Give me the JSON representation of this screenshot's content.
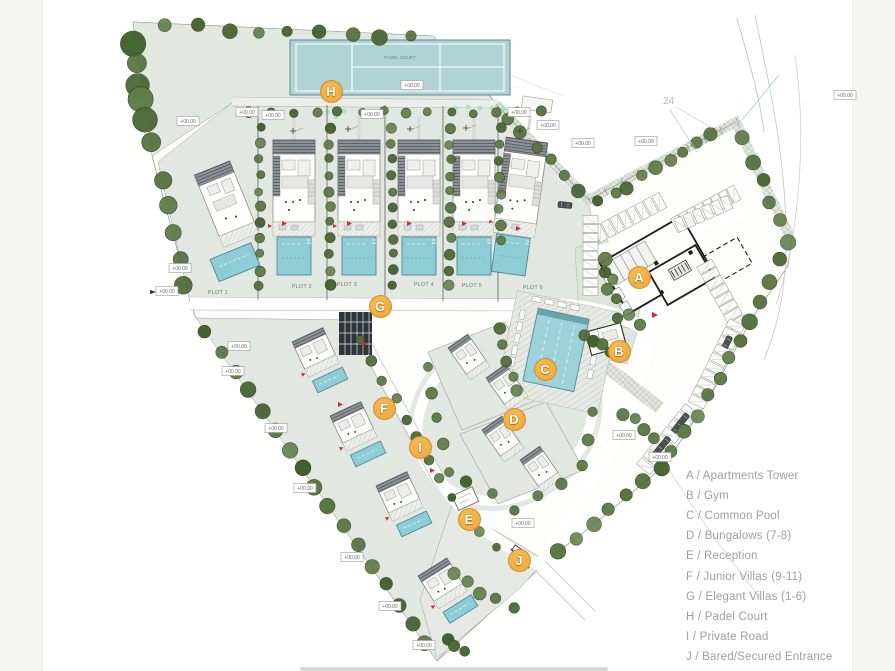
{
  "page": {
    "background": "#ffffff",
    "left_strip_color": "#f5f5f3",
    "right_strip_color": "#f5f5f3",
    "scrollbar_color": "#d9d9d9"
  },
  "legend": {
    "text_color": "#9e9e9e",
    "items": [
      {
        "key": "A",
        "label": "A / Apartments Tower"
      },
      {
        "key": "B",
        "label": "B / Gym"
      },
      {
        "key": "C",
        "label": "C / Common Pool"
      },
      {
        "key": "D",
        "label": "D / Bungalows (7-8)"
      },
      {
        "key": "E",
        "label": "E / Reception"
      },
      {
        "key": "F",
        "label": "F / Junior Villas (9-11)"
      },
      {
        "key": "G",
        "label": "G / Elegant Villas (1-6)"
      },
      {
        "key": "H",
        "label": "H / Padel Court"
      },
      {
        "key": "I",
        "label": "I / Private Road"
      },
      {
        "key": "J",
        "label": "J / Bared/Secured Entrance"
      }
    ]
  },
  "markers": {
    "fill": "#f0a93c",
    "border": "#cf8f2b",
    "text_color": "#ffffff",
    "pins": [
      {
        "letter": "A",
        "x": 639,
        "y": 277
      },
      {
        "letter": "B",
        "x": 619,
        "y": 351
      },
      {
        "letter": "C",
        "x": 545,
        "y": 369
      },
      {
        "letter": "D",
        "x": 514,
        "y": 419
      },
      {
        "letter": "E",
        "x": 469,
        "y": 519
      },
      {
        "letter": "F",
        "x": 384,
        "y": 408
      },
      {
        "letter": "G",
        "x": 380,
        "y": 306
      },
      {
        "letter": "H",
        "x": 331,
        "y": 91
      },
      {
        "letter": "I",
        "x": 420,
        "y": 447
      },
      {
        "letter": "J",
        "x": 519,
        "y": 560
      }
    ]
  },
  "map": {
    "plot_labels": [
      "PLOT 1",
      "PLOT 2",
      "PLOT 3",
      "PLOT 4",
      "PLOT 5",
      "PLOT 6"
    ],
    "court_label": "PADEL COURT",
    "contour_label": "24",
    "elevation_label": "+00.00",
    "colors": {
      "parcel": "#e3e7e1",
      "tree": "#4e6a38",
      "pool": "#8ecdd6",
      "court": "#b0d4d6",
      "tower_outline": "#1d1d1d",
      "road_edge": "#b2b6ad"
    }
  }
}
